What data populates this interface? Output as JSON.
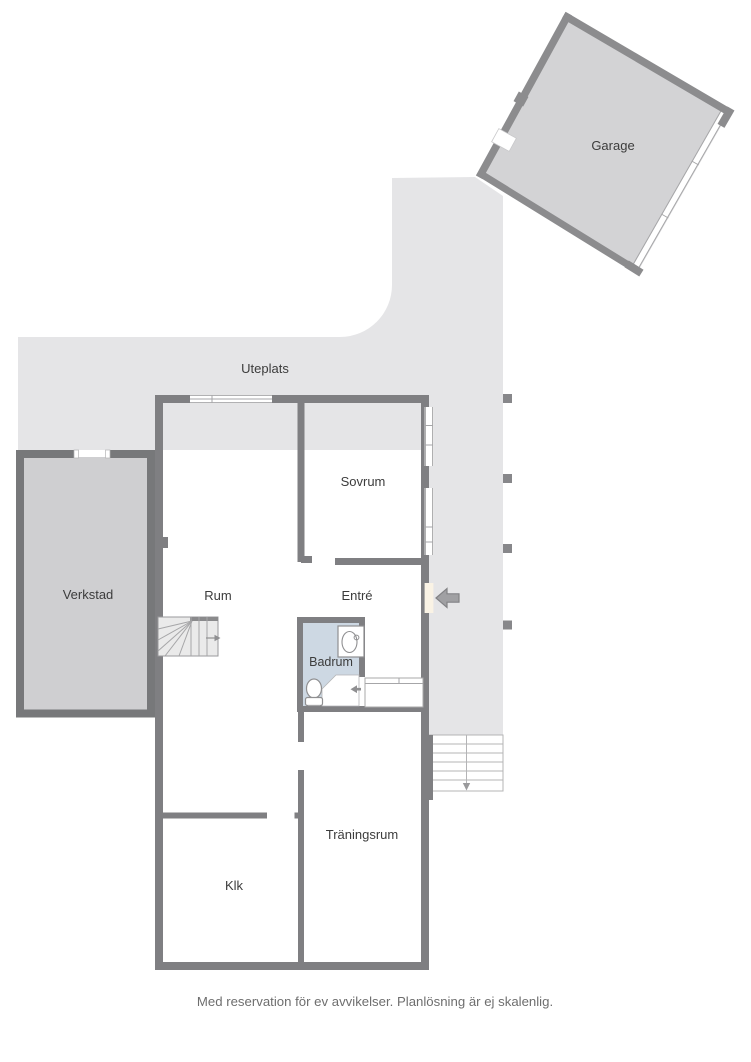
{
  "plan": {
    "type": "floorplan",
    "labels": {
      "garage": "Garage",
      "uteplats": "Uteplats",
      "verkstad": "Verkstad",
      "sovrum": "Sovrum",
      "rum": "Rum",
      "entre": "Entré",
      "badrum": "Badrum",
      "traningsrum": "Träningsrum",
      "klk": "Klk"
    },
    "caption": "Med reservation för ev avvikelser. Planlösning är ej skalenlig.",
    "colors": {
      "patio": "#e5e5e7",
      "garage_floor": "#d3d3d5",
      "verkstad_floor": "#cfcfd1",
      "house_floor": "#faf3e5",
      "bathroom_floor": "#cdd8e3",
      "stairs_fill": "#eaeaea",
      "house_wall": "#7f7f82",
      "outbuilding_wall": "#8c8c8e",
      "thin_line": "#a6a6a8",
      "label_text": "#3c3c3c",
      "caption_text": "#6e6e6e"
    }
  }
}
